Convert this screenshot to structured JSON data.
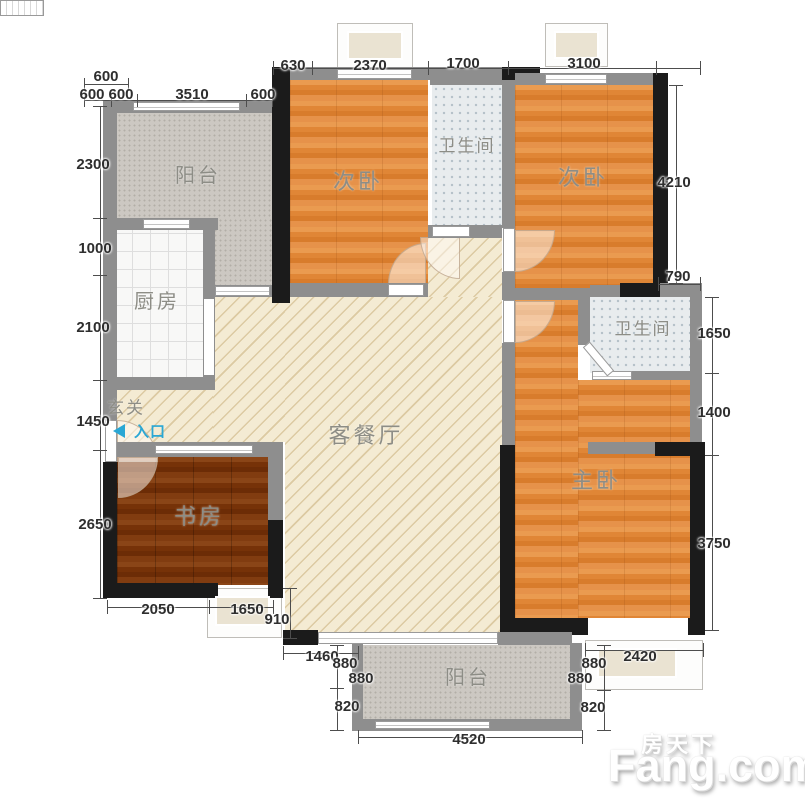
{
  "watermark": {
    "brand_cn": "房天下",
    "brand_en": "Fang.com"
  },
  "rooms": {
    "balcony_top": "阳台",
    "bedroom_a": "次卧",
    "bathroom_a": "卫生间",
    "bedroom_b": "次卧",
    "kitchen": "厨房",
    "foyer": "玄关",
    "entrance": "入口",
    "living_dining": "客餐厅",
    "study": "书房",
    "bathroom_b": "卫生间",
    "master_bedroom": "主卧",
    "balcony_bottom": "阳台"
  },
  "dims": {
    "top_left_row1": "600",
    "top_left_row2": [
      "600",
      "600",
      "3510",
      "600"
    ],
    "top": [
      "630",
      "2370",
      "1700",
      "3100"
    ],
    "left": [
      "2300",
      "1000",
      "2100",
      "1450",
      "2650"
    ],
    "right": [
      "4210",
      "790",
      "1650",
      "1400",
      "3750"
    ],
    "bottom_right": "2420",
    "bottom": "4520",
    "study_bottom": [
      "2050",
      "1650",
      "910"
    ],
    "balcony_left": [
      "1460",
      "880",
      "880",
      "820"
    ],
    "balcony_right": [
      "880",
      "880",
      "820"
    ]
  },
  "colors": {
    "wall_gray": "#8e8e8e",
    "wall_black": "#1b1b1b",
    "bedroom_floor": "#e08636",
    "study_floor": "#763208",
    "living_floor": "#f4ebd3",
    "bathroom_floor": "#e8ecee",
    "balcony_floor": "#ccc8c2",
    "kitchen_floor": "#f8f8f7",
    "entrance_blue": "#2aa7d4",
    "dimension_text": "#2e2e2e"
  }
}
